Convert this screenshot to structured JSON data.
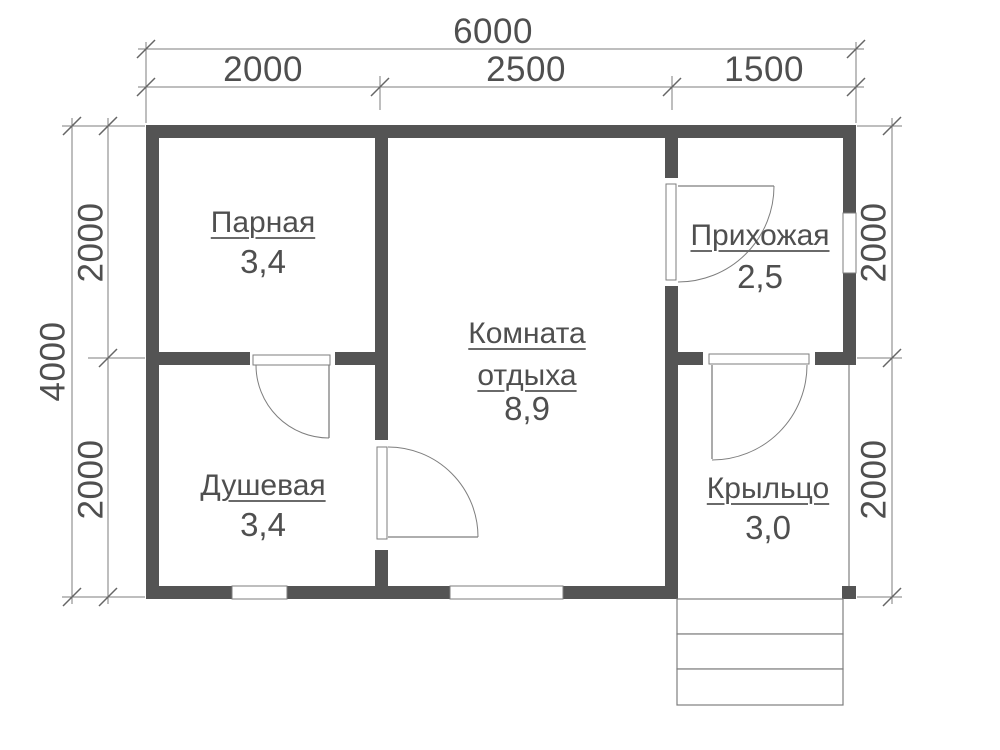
{
  "plan": {
    "type": "floor-plan",
    "rooms": [
      {
        "name": "Парная",
        "area": "3,4"
      },
      {
        "name": "Душевая",
        "area": "3,4"
      },
      {
        "name": "Комната отдыха",
        "area": "8,9"
      },
      {
        "name": "Прихожая",
        "area": "2,5"
      },
      {
        "name": "Крыльцо",
        "area": "3,0"
      }
    ],
    "dimensions": {
      "top": {
        "total": "6000",
        "segments": [
          "2000",
          "2500",
          "1500"
        ]
      },
      "left": {
        "total": "4000",
        "segments": [
          "2000",
          "2000"
        ]
      },
      "right": {
        "segments": [
          "2000",
          "2000"
        ]
      }
    },
    "colors": {
      "wall": "#545454",
      "thin_line": "#7e7e7e",
      "text": "#4f4f4f",
      "background": "#ffffff"
    }
  }
}
